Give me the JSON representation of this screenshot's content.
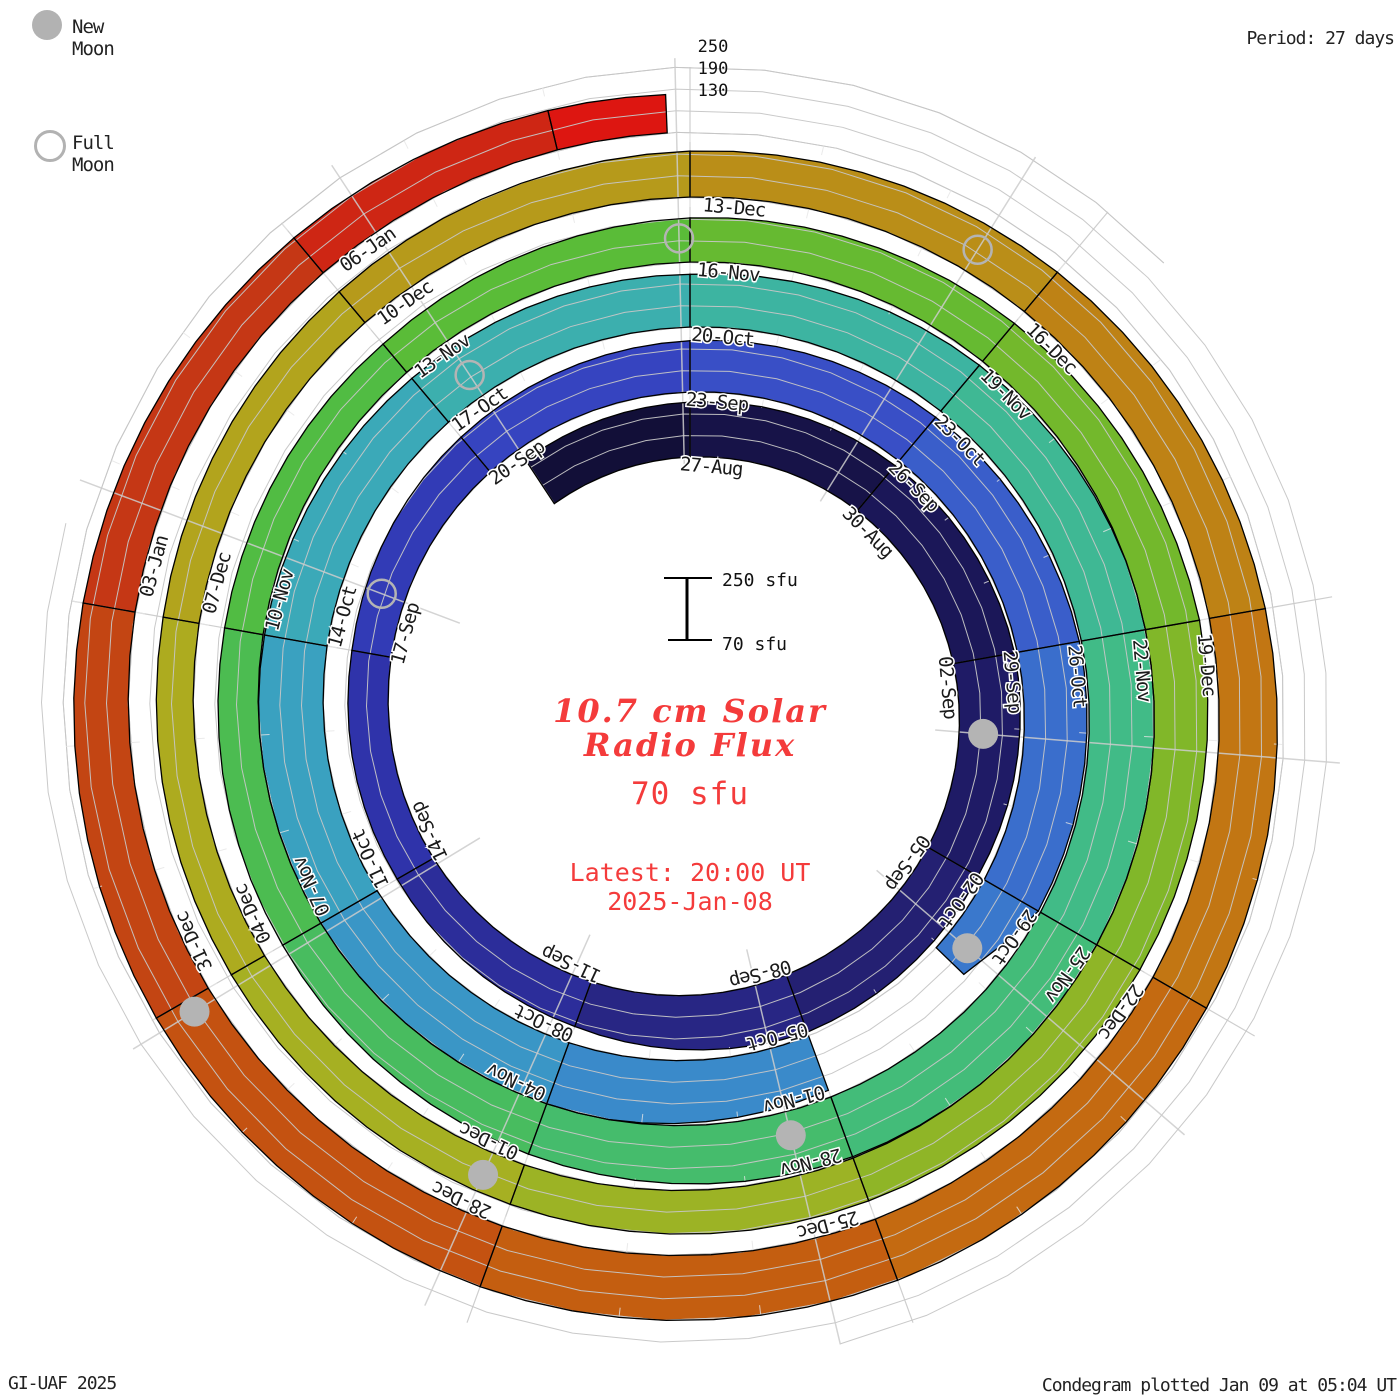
{
  "legend": {
    "new_moon_label": "New Moon",
    "full_moon_label": "Full Moon"
  },
  "period_label": "Period: 27 days",
  "credit": "GI-UAF 2025",
  "plotted_label": "Condegram plotted Jan 09 at 05:04 UT",
  "center": {
    "title_line1": "10.7 cm Solar",
    "title_line2": "Radio Flux",
    "baseline_label": "70 sfu",
    "latest_line1": "Latest: 20:00 UT",
    "latest_line2": "2025-Jan-08"
  },
  "scale_bar": {
    "top_label": "250 sfu",
    "bottom_label": "70 sfu"
  },
  "radial_axis_labels": [
    "250",
    "190",
    "130"
  ],
  "colors": {
    "accent_red_text": "#f43b3b",
    "grid_gray": "#c6c6c6",
    "moon_gray": "#b4b4b4",
    "tick_black": "#000000"
  },
  "chart_data": {
    "type": "spiral_polar_band_condegram",
    "title": "10.7 cm Solar Radio Flux",
    "period_days": 27,
    "degrees_per_day": 13.333,
    "flux_scale_sfu": [
      70,
      250
    ],
    "gridline_levels_sfu": [
      70,
      130,
      190,
      250
    ],
    "ring_start_dates": [
      "27-Aug",
      "23-Sep",
      "20-Oct",
      "16-Nov",
      "13-Dec"
    ],
    "start": "2024-Aug-24",
    "latest": "2025-Jan-08 20:00 UT",
    "tick_label_start_t": 0,
    "tick_label_step_days": 3,
    "tick_labels": [
      "27-Aug",
      "30-Aug",
      "02-Sep",
      "05-Sep",
      "08-Sep",
      "11-Sep",
      "14-Sep",
      "17-Sep",
      "20-Sep",
      "23-Sep",
      "26-Sep",
      "29-Sep",
      "02-Oct",
      "05-Oct",
      "08-Oct",
      "11-Oct",
      "14-Oct",
      "17-Oct",
      "20-Oct",
      "23-Oct",
      "26-Oct",
      "29-Oct",
      "01-Nov",
      "04-Nov",
      "07-Nov",
      "10-Nov",
      "13-Nov",
      "16-Nov",
      "19-Nov",
      "22-Nov",
      "25-Nov",
      "28-Nov",
      "01-Dec",
      "04-Dec",
      "07-Dec",
      "10-Dec",
      "13-Dec",
      "16-Dec",
      "19-Dec",
      "22-Dec",
      "25-Dec",
      "28-Dec",
      "31-Dec",
      "03-Jan",
      "06-Jan"
    ],
    "flux_series_estimated_sfu": [
      {
        "t": -2.5,
        "date": "24-Aug",
        "sfu": 215
      },
      {
        "t": 0,
        "date": "27-Aug",
        "sfu": 222
      },
      {
        "t": 3,
        "date": "30-Aug",
        "sfu": 233
      },
      {
        "t": 6,
        "date": "02-Sep",
        "sfu": 242
      },
      {
        "t": 9,
        "date": "05-Sep",
        "sfu": 230
      },
      {
        "t": 12,
        "date": "08-Sep",
        "sfu": 239
      },
      {
        "t": 15,
        "date": "11-Sep",
        "sfu": 202
      },
      {
        "t": 18,
        "date": "14-Sep",
        "sfu": 186
      },
      {
        "t": 21,
        "date": "17-Sep",
        "sfu": 180
      },
      {
        "t": 24,
        "date": "20-Sep",
        "sfu": 196
      },
      {
        "t": 27,
        "date": "23-Sep",
        "sfu": 212
      },
      {
        "t": 30,
        "date": "26-Sep",
        "sfu": 228
      },
      {
        "t": 33,
        "date": "29-Sep",
        "sfu": 244
      },
      {
        "t": 36,
        "date": "02-Oct",
        "sfu": 243
      },
      {
        "t": 37,
        "date": "03-Oct",
        "sfu": 175
      },
      {
        "t": 39,
        "date": "05-Oct",
        "sfu": 230
      },
      {
        "t": 42,
        "date": "08-Oct",
        "sfu": 256
      },
      {
        "t": 45,
        "date": "11-Oct",
        "sfu": 258
      },
      {
        "t": 48,
        "date": "14-Oct",
        "sfu": 246
      },
      {
        "t": 51,
        "date": "17-Oct",
        "sfu": 228
      },
      {
        "t": 54,
        "date": "20-Oct",
        "sfu": 216
      },
      {
        "t": 57,
        "date": "23-Oct",
        "sfu": 236
      },
      {
        "t": 60,
        "date": "26-Oct",
        "sfu": 253
      },
      {
        "t": 63,
        "date": "29-Oct",
        "sfu": 255
      },
      {
        "t": 66,
        "date": "01-Nov",
        "sfu": 246
      },
      {
        "t": 69,
        "date": "04-Nov",
        "sfu": 218
      },
      {
        "t": 72,
        "date": "07-Nov",
        "sfu": 192
      },
      {
        "t": 75,
        "date": "10-Nov",
        "sfu": 178
      },
      {
        "t": 78,
        "date": "13-Nov",
        "sfu": 172
      },
      {
        "t": 81,
        "date": "16-Nov",
        "sfu": 192
      },
      {
        "t": 84,
        "date": "19-Nov",
        "sfu": 207
      },
      {
        "t": 87,
        "date": "22-Nov",
        "sfu": 222
      },
      {
        "t": 90,
        "date": "25-Nov",
        "sfu": 208
      },
      {
        "t": 93,
        "date": "28-Nov",
        "sfu": 196
      },
      {
        "t": 96,
        "date": "01-Dec",
        "sfu": 186
      },
      {
        "t": 99,
        "date": "04-Dec",
        "sfu": 176
      },
      {
        "t": 102,
        "date": "07-Dec",
        "sfu": 171
      },
      {
        "t": 105,
        "date": "10-Dec",
        "sfu": 181
      },
      {
        "t": 108,
        "date": "13-Dec",
        "sfu": 197
      },
      {
        "t": 111,
        "date": "16-Dec",
        "sfu": 212
      },
      {
        "t": 114,
        "date": "19-Dec",
        "sfu": 227
      },
      {
        "t": 117,
        "date": "22-Dec",
        "sfu": 241
      },
      {
        "t": 120,
        "date": "25-Dec",
        "sfu": 251
      },
      {
        "t": 123,
        "date": "28-Dec",
        "sfu": 249
      },
      {
        "t": 126,
        "date": "31-Dec",
        "sfu": 236
      },
      {
        "t": 129,
        "date": "03-Jan",
        "sfu": 216
      },
      {
        "t": 132,
        "date": "06-Jan",
        "sfu": 196
      },
      {
        "t": 134,
        "date": "08-Jan",
        "sfu": 182
      },
      {
        "t": 134.83,
        "date": "08-Jan 20:00",
        "sfu": 176
      }
    ],
    "data_gaps": [
      {
        "t_start": 37.05,
        "t_end": 39.0,
        "dates": "03-Oct to 05-Oct"
      }
    ],
    "moons": {
      "new": [
        {
          "t": 7.1,
          "date": "03-Sep"
        },
        {
          "t": 36.8,
          "date": "02-Oct"
        },
        {
          "t": 66.5,
          "date": "01-Nov"
        },
        {
          "t": 96.3,
          "date": "01-Dec"
        },
        {
          "t": 125.9,
          "date": "30-Dec"
        }
      ],
      "full": [
        {
          "t": 21.8,
          "date": "17-Sep"
        },
        {
          "t": 51.5,
          "date": "17-Oct"
        },
        {
          "t": 80.9,
          "date": "15-Nov"
        },
        {
          "t": 110.4,
          "date": "15-Dec"
        }
      ]
    },
    "colormap_time_anchors": [
      [
        -2.5,
        "#0f0c30"
      ],
      [
        0,
        "#151140"
      ],
      [
        6,
        "#1d1960"
      ],
      [
        12,
        "#262278"
      ],
      [
        15,
        "#2a2a90"
      ],
      [
        18,
        "#2d30a4"
      ],
      [
        21,
        "#3036b0"
      ],
      [
        24,
        "#3340bc"
      ],
      [
        27,
        "#3848c4"
      ],
      [
        30,
        "#3a56c8"
      ],
      [
        33,
        "#3a66cc"
      ],
      [
        36,
        "#3a76cc"
      ],
      [
        39,
        "#3a84cc"
      ],
      [
        42,
        "#3a90c8"
      ],
      [
        45,
        "#3a9cc4"
      ],
      [
        48,
        "#3aa6bc"
      ],
      [
        51,
        "#3cacb4"
      ],
      [
        54,
        "#3cb2a8"
      ],
      [
        57,
        "#3eb69a"
      ],
      [
        60,
        "#40ba8e"
      ],
      [
        63,
        "#42bc80"
      ],
      [
        66,
        "#44bc72"
      ],
      [
        69,
        "#46bc66"
      ],
      [
        72,
        "#4abc58"
      ],
      [
        75,
        "#4ebc4a"
      ],
      [
        78,
        "#54bc3c"
      ],
      [
        81,
        "#60bc34"
      ],
      [
        84,
        "#6cb82e"
      ],
      [
        87,
        "#7ab82a"
      ],
      [
        90,
        "#88b628"
      ],
      [
        93,
        "#96b426"
      ],
      [
        96,
        "#a2b224"
      ],
      [
        99,
        "#aaae20"
      ],
      [
        102,
        "#b0a81e"
      ],
      [
        105,
        "#b4a01c"
      ],
      [
        108,
        "#b8941a"
      ],
      [
        111,
        "#bc8816"
      ],
      [
        114,
        "#c07c14"
      ],
      [
        117,
        "#c47012"
      ],
      [
        120,
        "#c46410"
      ],
      [
        123,
        "#c45810"
      ],
      [
        126,
        "#c44c12"
      ],
      [
        129,
        "#c23e14"
      ],
      [
        132,
        "#c83016"
      ],
      [
        134,
        "#d41c12"
      ],
      [
        134.83,
        "#e61010"
      ]
    ]
  }
}
